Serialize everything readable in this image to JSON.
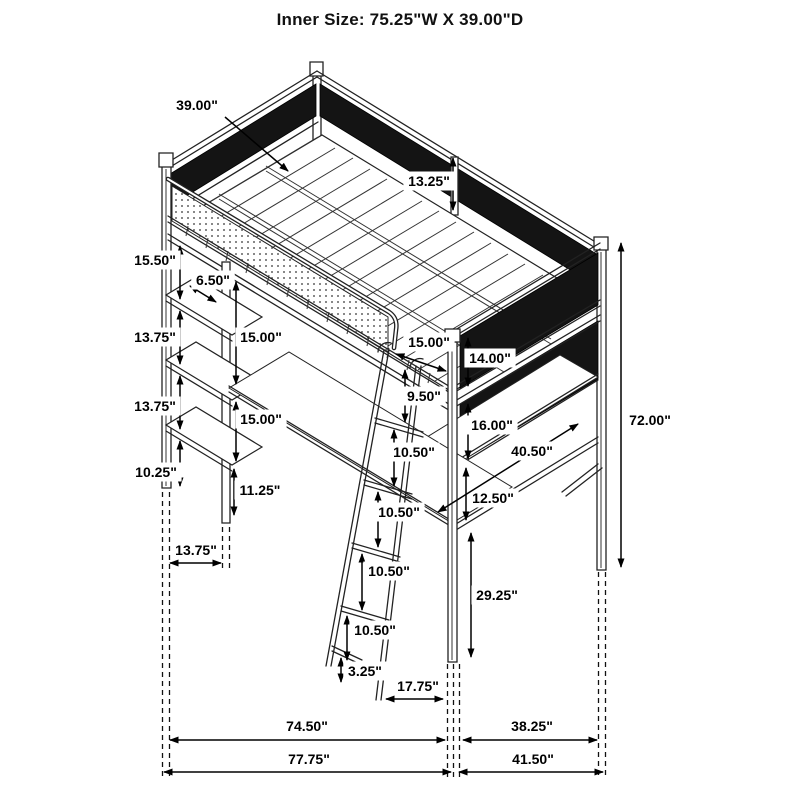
{
  "title": "Inner Size: 75.25\"W X 39.00\"D",
  "units": "inches",
  "annotations": [
    {
      "id": "inner-depth",
      "label": "39.00\"",
      "lx": 197,
      "ly": 105,
      "arrow": {
        "x1": 225,
        "y1": 117,
        "x2": 288,
        "y2": 171,
        "heads": "end"
      }
    },
    {
      "id": "guardrail-height",
      "label": "13.25\"",
      "lx": 429,
      "ly": 181,
      "arrow": {
        "x1": 453,
        "y1": 158,
        "x2": 453,
        "y2": 210,
        "heads": "both"
      }
    },
    {
      "id": "bed-to-shelf1",
      "label": "15.50\"",
      "lx": 155,
      "ly": 260,
      "arrow": {
        "x1": 180,
        "y1": 246,
        "x2": 180,
        "y2": 299,
        "heads": "both"
      }
    },
    {
      "id": "shelf-offset",
      "label": "6.50\"",
      "lx": 213,
      "ly": 280,
      "arrow": {
        "x1": 190,
        "y1": 286,
        "x2": 216,
        "y2": 302,
        "heads": "both"
      }
    },
    {
      "id": "shelf1-to-shelf2",
      "label": "13.75\"",
      "lx": 155,
      "ly": 337,
      "arrow": {
        "x1": 180,
        "y1": 311,
        "x2": 180,
        "y2": 364,
        "heads": "both"
      }
    },
    {
      "id": "rail-to-desk",
      "label": "15.00\"",
      "lx": 261,
      "ly": 337,
      "arrow": {
        "x1": 236,
        "y1": 282,
        "x2": 236,
        "y2": 384,
        "heads": "both"
      }
    },
    {
      "id": "shelf2-to-shelf3",
      "label": "13.75\"",
      "lx": 155,
      "ly": 406,
      "arrow": {
        "x1": 180,
        "y1": 376,
        "x2": 180,
        "y2": 429,
        "heads": "both"
      }
    },
    {
      "id": "desk-to-shelf3",
      "label": "15.00\"",
      "lx": 261,
      "ly": 419,
      "arrow": {
        "x1": 236,
        "y1": 402,
        "x2": 236,
        "y2": 461,
        "heads": "both"
      }
    },
    {
      "id": "shelf3-to-bottom",
      "label": "10.25\"",
      "lx": 156,
      "ly": 472,
      "arrow": {
        "x1": 180,
        "y1": 441,
        "x2": 180,
        "y2": 486,
        "heads": "both"
      }
    },
    {
      "id": "desk-leg",
      "label": "11.25\"",
      "lx": 260,
      "ly": 490,
      "arrow": {
        "x1": 234,
        "y1": 469,
        "x2": 234,
        "y2": 515,
        "heads": "both"
      }
    },
    {
      "id": "tower-width",
      "label": "13.75\"",
      "lx": 196,
      "ly": 550,
      "arrow": {
        "x1": 170,
        "y1": 563,
        "x2": 221,
        "y2": 563,
        "heads": "both"
      }
    },
    {
      "id": "rail-to-post",
      "label": "15.00\"",
      "lx": 429,
      "ly": 342,
      "arrow": {
        "x1": 396,
        "y1": 354,
        "x2": 446,
        "y2": 371,
        "heads": "both"
      }
    },
    {
      "id": "ladder-top-gap",
      "label": "9.50\"",
      "lx": 424,
      "ly": 396,
      "arrow": {
        "x1": 405,
        "y1": 370,
        "x2": 405,
        "y2": 422,
        "heads": "both"
      }
    },
    {
      "id": "rung-gap-1",
      "label": "10.50\"",
      "lx": 414,
      "ly": 452,
      "arrow": {
        "x1": 394,
        "y1": 430,
        "x2": 394,
        "y2": 486,
        "heads": "both"
      }
    },
    {
      "id": "rung-gap-2",
      "label": "10.50\"",
      "lx": 399,
      "ly": 512,
      "arrow": {
        "x1": 378,
        "y1": 492,
        "x2": 378,
        "y2": 547,
        "heads": "both"
      }
    },
    {
      "id": "rung-gap-3",
      "label": "10.50\"",
      "lx": 389,
      "ly": 571,
      "arrow": {
        "x1": 362,
        "y1": 554,
        "x2": 362,
        "y2": 610,
        "heads": "both"
      }
    },
    {
      "id": "rung-gap-4",
      "label": "10.50\"",
      "lx": 375,
      "ly": 630,
      "arrow": {
        "x1": 347,
        "y1": 616,
        "x2": 347,
        "y2": 660,
        "heads": "both"
      }
    },
    {
      "id": "ladder-foot",
      "label": "3.25\"",
      "lx": 365,
      "ly": 671,
      "arrow": {
        "x1": 341,
        "y1": 658,
        "x2": 341,
        "y2": 682,
        "heads": "both"
      }
    },
    {
      "id": "ladder-offset",
      "label": "17.75\"",
      "lx": 418,
      "ly": 686,
      "arrow": {
        "x1": 386,
        "y1": 699,
        "x2": 443,
        "y2": 699,
        "heads": "both"
      }
    },
    {
      "id": "upper-mesh-height",
      "label": "14.00\"",
      "lx": 490,
      "ly": 358,
      "arrow": {
        "x1": 468,
        "y1": 338,
        "x2": 468,
        "y2": 386,
        "heads": "both"
      }
    },
    {
      "id": "lower-mesh-height",
      "label": "16.00\"",
      "lx": 492,
      "ly": 425,
      "arrow": {
        "x1": 468,
        "y1": 404,
        "x2": 468,
        "y2": 459,
        "heads": "both"
      }
    },
    {
      "id": "mesh-to-rail",
      "label": "12.50\"",
      "lx": 493,
      "ly": 498,
      "arrow": {
        "x1": 466,
        "y1": 468,
        "x2": 466,
        "y2": 520,
        "heads": "both"
      }
    },
    {
      "id": "shelf-diagonal",
      "label": "40.50\"",
      "lx": 532,
      "ly": 451,
      "arrow": {
        "x1": 438,
        "y1": 512,
        "x2": 578,
        "y2": 424,
        "heads": "both"
      }
    },
    {
      "id": "leg-height",
      "label": "29.25\"",
      "lx": 497,
      "ly": 595,
      "arrow": {
        "x1": 471,
        "y1": 533,
        "x2": 471,
        "y2": 657,
        "heads": "both"
      }
    },
    {
      "id": "total-height",
      "label": "72.00\"",
      "lx": 650,
      "ly": 420,
      "arrow": {
        "x1": 621,
        "y1": 243,
        "x2": 621,
        "y2": 567,
        "heads": "both"
      }
    },
    {
      "id": "base-span-left",
      "label": "74.50\"",
      "lx": 307,
      "ly": 726,
      "arrow": {
        "x1": 170,
        "y1": 740,
        "x2": 445,
        "y2": 740,
        "heads": "both"
      }
    },
    {
      "id": "base-span-right",
      "label": "38.25\"",
      "lx": 532,
      "ly": 726,
      "arrow": {
        "x1": 463,
        "y1": 740,
        "x2": 597,
        "y2": 740,
        "heads": "both"
      }
    },
    {
      "id": "overall-width",
      "label": "77.75\"",
      "lx": 309,
      "ly": 759,
      "arrow": {
        "x1": 164,
        "y1": 772,
        "x2": 451,
        "y2": 772,
        "heads": "both"
      }
    },
    {
      "id": "overall-depth",
      "label": "41.50\"",
      "lx": 533,
      "ly": 759,
      "arrow": {
        "x1": 459,
        "y1": 772,
        "x2": 603,
        "y2": 772,
        "heads": "both"
      }
    }
  ]
}
